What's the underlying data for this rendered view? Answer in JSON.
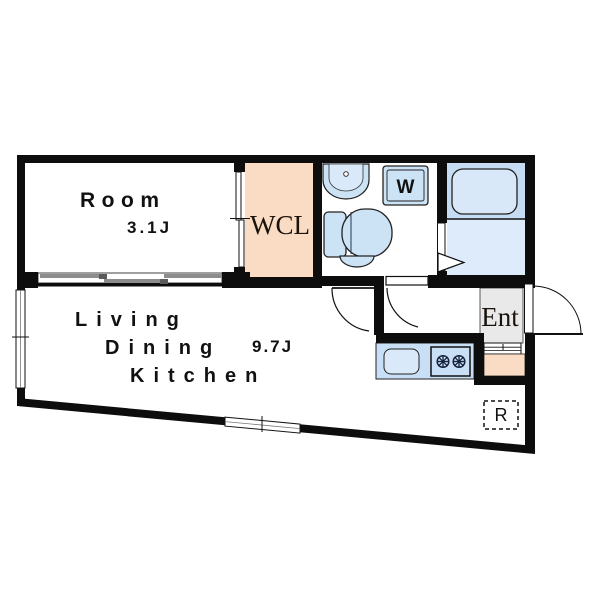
{
  "floorplan": {
    "labels": {
      "room": "Room",
      "room_area": "3.1J",
      "wcl": "WCL",
      "living": "Living",
      "dining": "Dining",
      "kitchen": "Kitchen",
      "ldk_area": "9.7J",
      "entrance": "Ent",
      "washer": "W",
      "refrigerator": "R"
    },
    "colors": {
      "wall": "#0D0D0D",
      "peach": "#F9DCC3",
      "fixture_blue": "#CCE2F5",
      "bath_upper_blue": "#C5DCF2",
      "bath_lower_blue": "#DEEBFB",
      "bathtub_blue": "#D9E8F9",
      "counter_blue": "#C8DFF5",
      "sink_blue": "#D9E9FA",
      "entrance_gray": "#E9E9E9",
      "window_gray": "#8C8C8C"
    }
  }
}
